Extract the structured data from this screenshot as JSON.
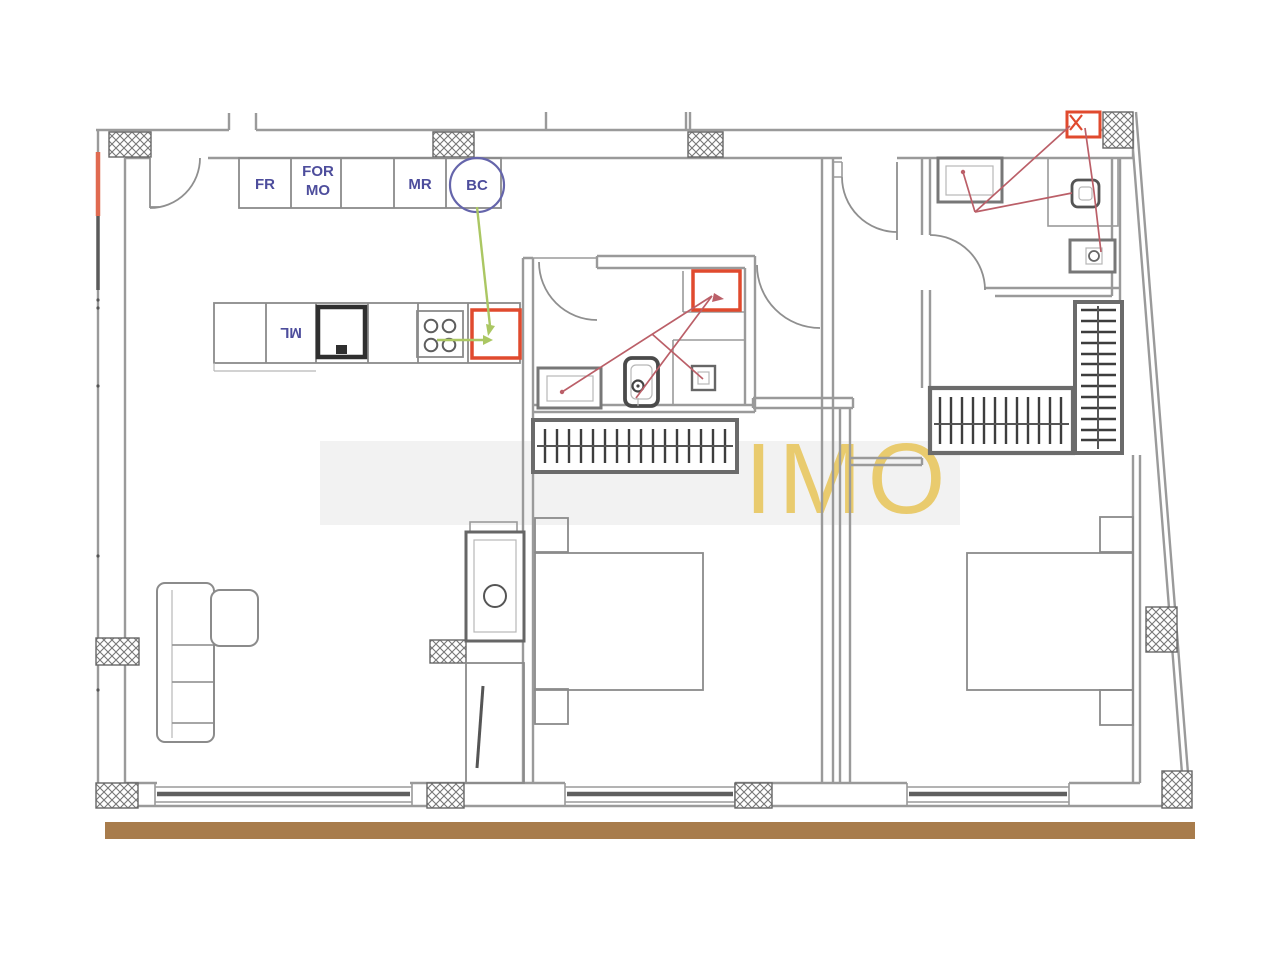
{
  "title": "apartment-floor-plan",
  "colors": {
    "wall": "#9a9a9a",
    "furniture": "#8b8b8b",
    "fixture-dark": "#3c3c3c",
    "label-blue": "#4d4d9c",
    "circle-blue": "#6565ab",
    "highlight-red": "#e04a2e",
    "annotation-red": "#bb5f68",
    "annotation-green": "#abc763",
    "watermark-yellow": "#e9c863",
    "footer-brown": "#a87c4c",
    "accent-orange": "#e06a50"
  },
  "labels": {
    "fridge": "FR",
    "oven_line1": "FOR",
    "oven_line2": "MO",
    "microwave": "MR",
    "boiler_circle": "BC",
    "washer": "ML"
  },
  "watermark": {
    "text": "IMO"
  }
}
